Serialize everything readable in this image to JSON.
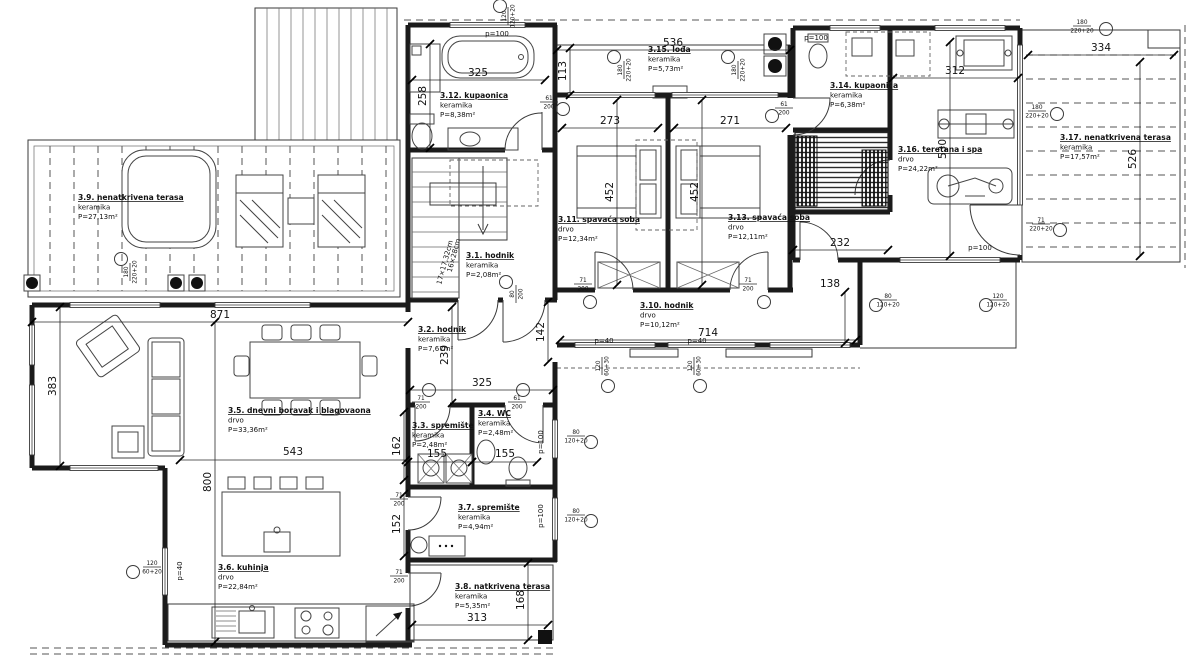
{
  "plan": {
    "rooms": [
      {
        "num": "3.1.",
        "name": "hodnik",
        "mat": "keramika",
        "area": "P=2,08m²",
        "x": 466,
        "y": 258
      },
      {
        "num": "3.2.",
        "name": "hodnik",
        "mat": "keramika",
        "area": "P=7,67m²",
        "x": 418,
        "y": 332
      },
      {
        "num": "3.3.",
        "name": "spremište",
        "mat": "keramika",
        "area": "P=2,48m²",
        "x": 412,
        "y": 428
      },
      {
        "num": "3.4.",
        "name": "WC",
        "mat": "keramika",
        "area": "P=2,48m²",
        "x": 478,
        "y": 416
      },
      {
        "num": "3.5.",
        "name": "dnevni boravak i blagovaona",
        "mat": "drvo",
        "area": "P=33,36m²",
        "x": 228,
        "y": 413
      },
      {
        "num": "3.6.",
        "name": "kuhinja",
        "mat": "drvo",
        "area": "P=22,84m²",
        "x": 218,
        "y": 570
      },
      {
        "num": "3.7.",
        "name": "spremište",
        "mat": "keramika",
        "area": "P=4,94m²",
        "x": 458,
        "y": 510
      },
      {
        "num": "3.8.",
        "name": "natkrivena terasa",
        "mat": "keramika",
        "area": "P=5,35m²",
        "x": 455,
        "y": 589
      },
      {
        "num": "3.9.",
        "name": "nenatkrivena terasa",
        "mat": "keramika",
        "area": "P=27,13m²",
        "x": 78,
        "y": 200
      },
      {
        "num": "3.10.",
        "name": "hodnik",
        "mat": "drvo",
        "area": "P=10,12m²",
        "x": 640,
        "y": 308
      },
      {
        "num": "3.11.",
        "name": "spavaća soba",
        "mat": "drvo",
        "area": "P=12,34m²",
        "x": 558,
        "y": 222
      },
      {
        "num": "3.12.",
        "name": "kupaonica",
        "mat": "keramika",
        "area": "P=8,38m²",
        "x": 440,
        "y": 98
      },
      {
        "num": "3.13.",
        "name": "spavaća soba",
        "mat": "drvo",
        "area": "P=12,11m²",
        "x": 728,
        "y": 220
      },
      {
        "num": "3.14.",
        "name": "kupaonica",
        "mat": "keramika",
        "area": "P=6,38m²",
        "x": 830,
        "y": 88
      },
      {
        "num": "3.15.",
        "name": "lođa",
        "mat": "keramika",
        "area": "P=5,73m²",
        "x": 648,
        "y": 52
      },
      {
        "num": "3.16.",
        "name": "teretana i spa",
        "mat": "drvo",
        "area": "P=24,22m²",
        "x": 898,
        "y": 152
      },
      {
        "num": "3.17.",
        "name": "nenatkrivena terasa",
        "mat": "keramika",
        "area": "P=17,57m²",
        "x": 1060,
        "y": 140
      }
    ],
    "dimensions": [
      {
        "v": "536",
        "x": 673,
        "y": 46,
        "line": [
          557,
          50,
          790,
          50
        ]
      },
      {
        "v": "325",
        "x": 478,
        "y": 76,
        "line": [
          412,
          80,
          545,
          80
        ]
      },
      {
        "v": "113",
        "x": 566,
        "y": 71,
        "rot": -90,
        "line": [
          570,
          48,
          570,
          95
        ]
      },
      {
        "v": "273",
        "x": 610,
        "y": 124,
        "line": [
          562,
          128,
          658,
          128
        ]
      },
      {
        "v": "271",
        "x": 730,
        "y": 124,
        "line": [
          674,
          128,
          786,
          128
        ]
      },
      {
        "v": "452",
        "x": 613,
        "y": 192,
        "rot": -90,
        "line": [
          617,
          100,
          617,
          285
        ]
      },
      {
        "v": "452",
        "x": 698,
        "y": 192,
        "rot": -90,
        "line": [
          702,
          100,
          702,
          285
        ]
      },
      {
        "v": "312",
        "x": 955,
        "y": 74,
        "line": [
          893,
          78,
          1018,
          78
        ]
      },
      {
        "v": "334",
        "x": 1101,
        "y": 51,
        "line": [
          1028,
          55,
          1174,
          55
        ]
      },
      {
        "v": "526",
        "x": 1136,
        "y": 159,
        "rot": -90,
        "line": [
          1140,
          62,
          1140,
          256
        ]
      },
      {
        "v": "530",
        "x": 946,
        "y": 149,
        "rot": -90,
        "line": [
          950,
          42,
          950,
          256
        ]
      },
      {
        "v": "258",
        "x": 426,
        "y": 96,
        "rot": -90,
        "line": [
          430,
          44,
          430,
          148
        ]
      },
      {
        "v": "871",
        "x": 220,
        "y": 318,
        "line": [
          32,
          322,
          408,
          322
        ]
      },
      {
        "v": "383",
        "x": 56,
        "y": 386,
        "rot": -90,
        "line": [
          60,
          307,
          60,
          466
        ]
      },
      {
        "v": "800",
        "x": 211,
        "y": 482,
        "rot": -90,
        "line": [
          215,
          322,
          215,
          642
        ]
      },
      {
        "v": "543",
        "x": 293,
        "y": 455,
        "line": [
          180,
          460,
          406,
          460
        ]
      },
      {
        "v": "239",
        "x": 448,
        "y": 355,
        "rot": -90,
        "line": [
          452,
          307,
          452,
          403
        ]
      },
      {
        "v": "325",
        "x": 482,
        "y": 386,
        "line": [
          410,
          390,
          553,
          390
        ]
      },
      {
        "v": "142",
        "x": 544,
        "y": 332,
        "rot": -90,
        "line": [
          548,
          302,
          548,
          362
        ]
      },
      {
        "v": "714",
        "x": 708,
        "y": 336,
        "line": [
          560,
          340,
          856,
          340
        ]
      },
      {
        "v": "138",
        "x": 830,
        "y": 287,
        "line": [
          845,
          292,
          845,
          343
        ]
      },
      {
        "v": "232",
        "x": 840,
        "y": 246,
        "line": [
          793,
          250,
          888,
          250
        ]
      },
      {
        "v": "155",
        "x": 437,
        "y": 457,
        "line": [
          408,
          462,
          472,
          462
        ]
      },
      {
        "v": "155",
        "x": 505,
        "y": 457,
        "line": [
          472,
          462,
          537,
          462
        ]
      },
      {
        "v": "162",
        "x": 400,
        "y": 446,
        "rot": -90,
        "line": [
          404,
          412,
          404,
          480
        ]
      },
      {
        "v": "152",
        "x": 400,
        "y": 524,
        "rot": -90,
        "line": [
          404,
          494,
          404,
          556
        ]
      },
      {
        "v": "313",
        "x": 477,
        "y": 621,
        "line": [
          412,
          625,
          548,
          625
        ]
      },
      {
        "v": "168",
        "x": 524,
        "y": 600,
        "rot": -90,
        "line": [
          528,
          563,
          528,
          640
        ]
      }
    ],
    "notes": [
      {
        "t": "p=100",
        "x": 497,
        "y": 36
      },
      {
        "t": "p=100",
        "x": 816,
        "y": 40
      },
      {
        "t": "p=100",
        "x": 980,
        "y": 250
      },
      {
        "t": "p=100",
        "x": 543,
        "y": 442,
        "rot": -90
      },
      {
        "t": "p=100",
        "x": 543,
        "y": 516,
        "rot": -90
      },
      {
        "t": "p=40",
        "x": 604,
        "y": 343
      },
      {
        "t": "p=40",
        "x": 697,
        "y": 343
      },
      {
        "t": "p=40",
        "x": 182,
        "y": 571,
        "rot": -90
      },
      {
        "t": "17×17,32cm",
        "x": 447,
        "y": 263,
        "rot": -75,
        "size": 6
      },
      {
        "t": "16×28cm",
        "x": 456,
        "y": 256,
        "rot": -75,
        "size": 6
      }
    ],
    "opening_tags": [
      {
        "a": "61",
        "b": "200",
        "x": 549,
        "y": 100,
        "cx": 563,
        "cy": 109
      },
      {
        "a": "61",
        "b": "200",
        "x": 784,
        "y": 106,
        "cx": 772,
        "cy": 116
      },
      {
        "a": "71",
        "b": "200",
        "x": 583,
        "y": 282,
        "cx": 590,
        "cy": 302
      },
      {
        "a": "71",
        "b": "200",
        "x": 748,
        "y": 282,
        "cx": 764,
        "cy": 302
      },
      {
        "a": "71",
        "b": "200",
        "x": 421,
        "y": 400,
        "cx": 429,
        "cy": 390
      },
      {
        "a": "61",
        "b": "200",
        "x": 517,
        "y": 400,
        "cx": 523,
        "cy": 390
      },
      {
        "a": "71",
        "b": "200",
        "x": 399,
        "y": 497
      },
      {
        "a": "71",
        "b": "200",
        "x": 399,
        "y": 574
      },
      {
        "a": "80",
        "b": "120+20",
        "x": 576,
        "y": 434,
        "cx": 591,
        "cy": 442
      },
      {
        "a": "80",
        "b": "120+20",
        "x": 576,
        "y": 513,
        "cx": 591,
        "cy": 521
      },
      {
        "a": "71",
        "b": "220+20",
        "x": 1041,
        "y": 222,
        "cx": 1060,
        "cy": 230
      },
      {
        "a": "120",
        "b": "60+20",
        "x": 152,
        "y": 565,
        "cx": 133,
        "cy": 572
      },
      {
        "a": "120",
        "b": "60+30",
        "x": 600,
        "y": 366,
        "rot": -90,
        "cx": 608,
        "cy": 386
      },
      {
        "a": "120",
        "b": "60+30",
        "x": 692,
        "y": 366,
        "rot": -90,
        "cx": 700,
        "cy": 386
      },
      {
        "a": "180",
        "b": "220+20",
        "x": 622,
        "y": 70,
        "rot": -90,
        "cx": 614,
        "cy": 57
      },
      {
        "a": "180",
        "b": "220+20",
        "x": 736,
        "y": 70,
        "rot": -90,
        "cx": 728,
        "cy": 57
      },
      {
        "a": "180",
        "b": "220+20",
        "x": 128,
        "y": 272,
        "rot": -90,
        "cx": 121,
        "cy": 259
      },
      {
        "a": "180",
        "b": "220+20",
        "x": 1037,
        "y": 109,
        "cx": 1057,
        "cy": 114
      },
      {
        "a": "180",
        "b": "220+20",
        "x": 1082,
        "y": 24,
        "cx": 1106,
        "cy": 29
      },
      {
        "a": "120",
        "b": "120+20",
        "x": 506,
        "y": 16,
        "rot": -90,
        "cx": 500,
        "cy": 6
      },
      {
        "a": "80",
        "b": "200",
        "x": 514,
        "y": 294,
        "rot": -90,
        "cx": 506,
        "cy": 282
      },
      {
        "a": "80",
        "b": "120+20",
        "x": 888,
        "y": 298,
        "cx": 876,
        "cy": 305
      },
      {
        "a": "120",
        "b": "120+20",
        "x": 998,
        "y": 298,
        "cx": 986,
        "cy": 305
      }
    ]
  }
}
